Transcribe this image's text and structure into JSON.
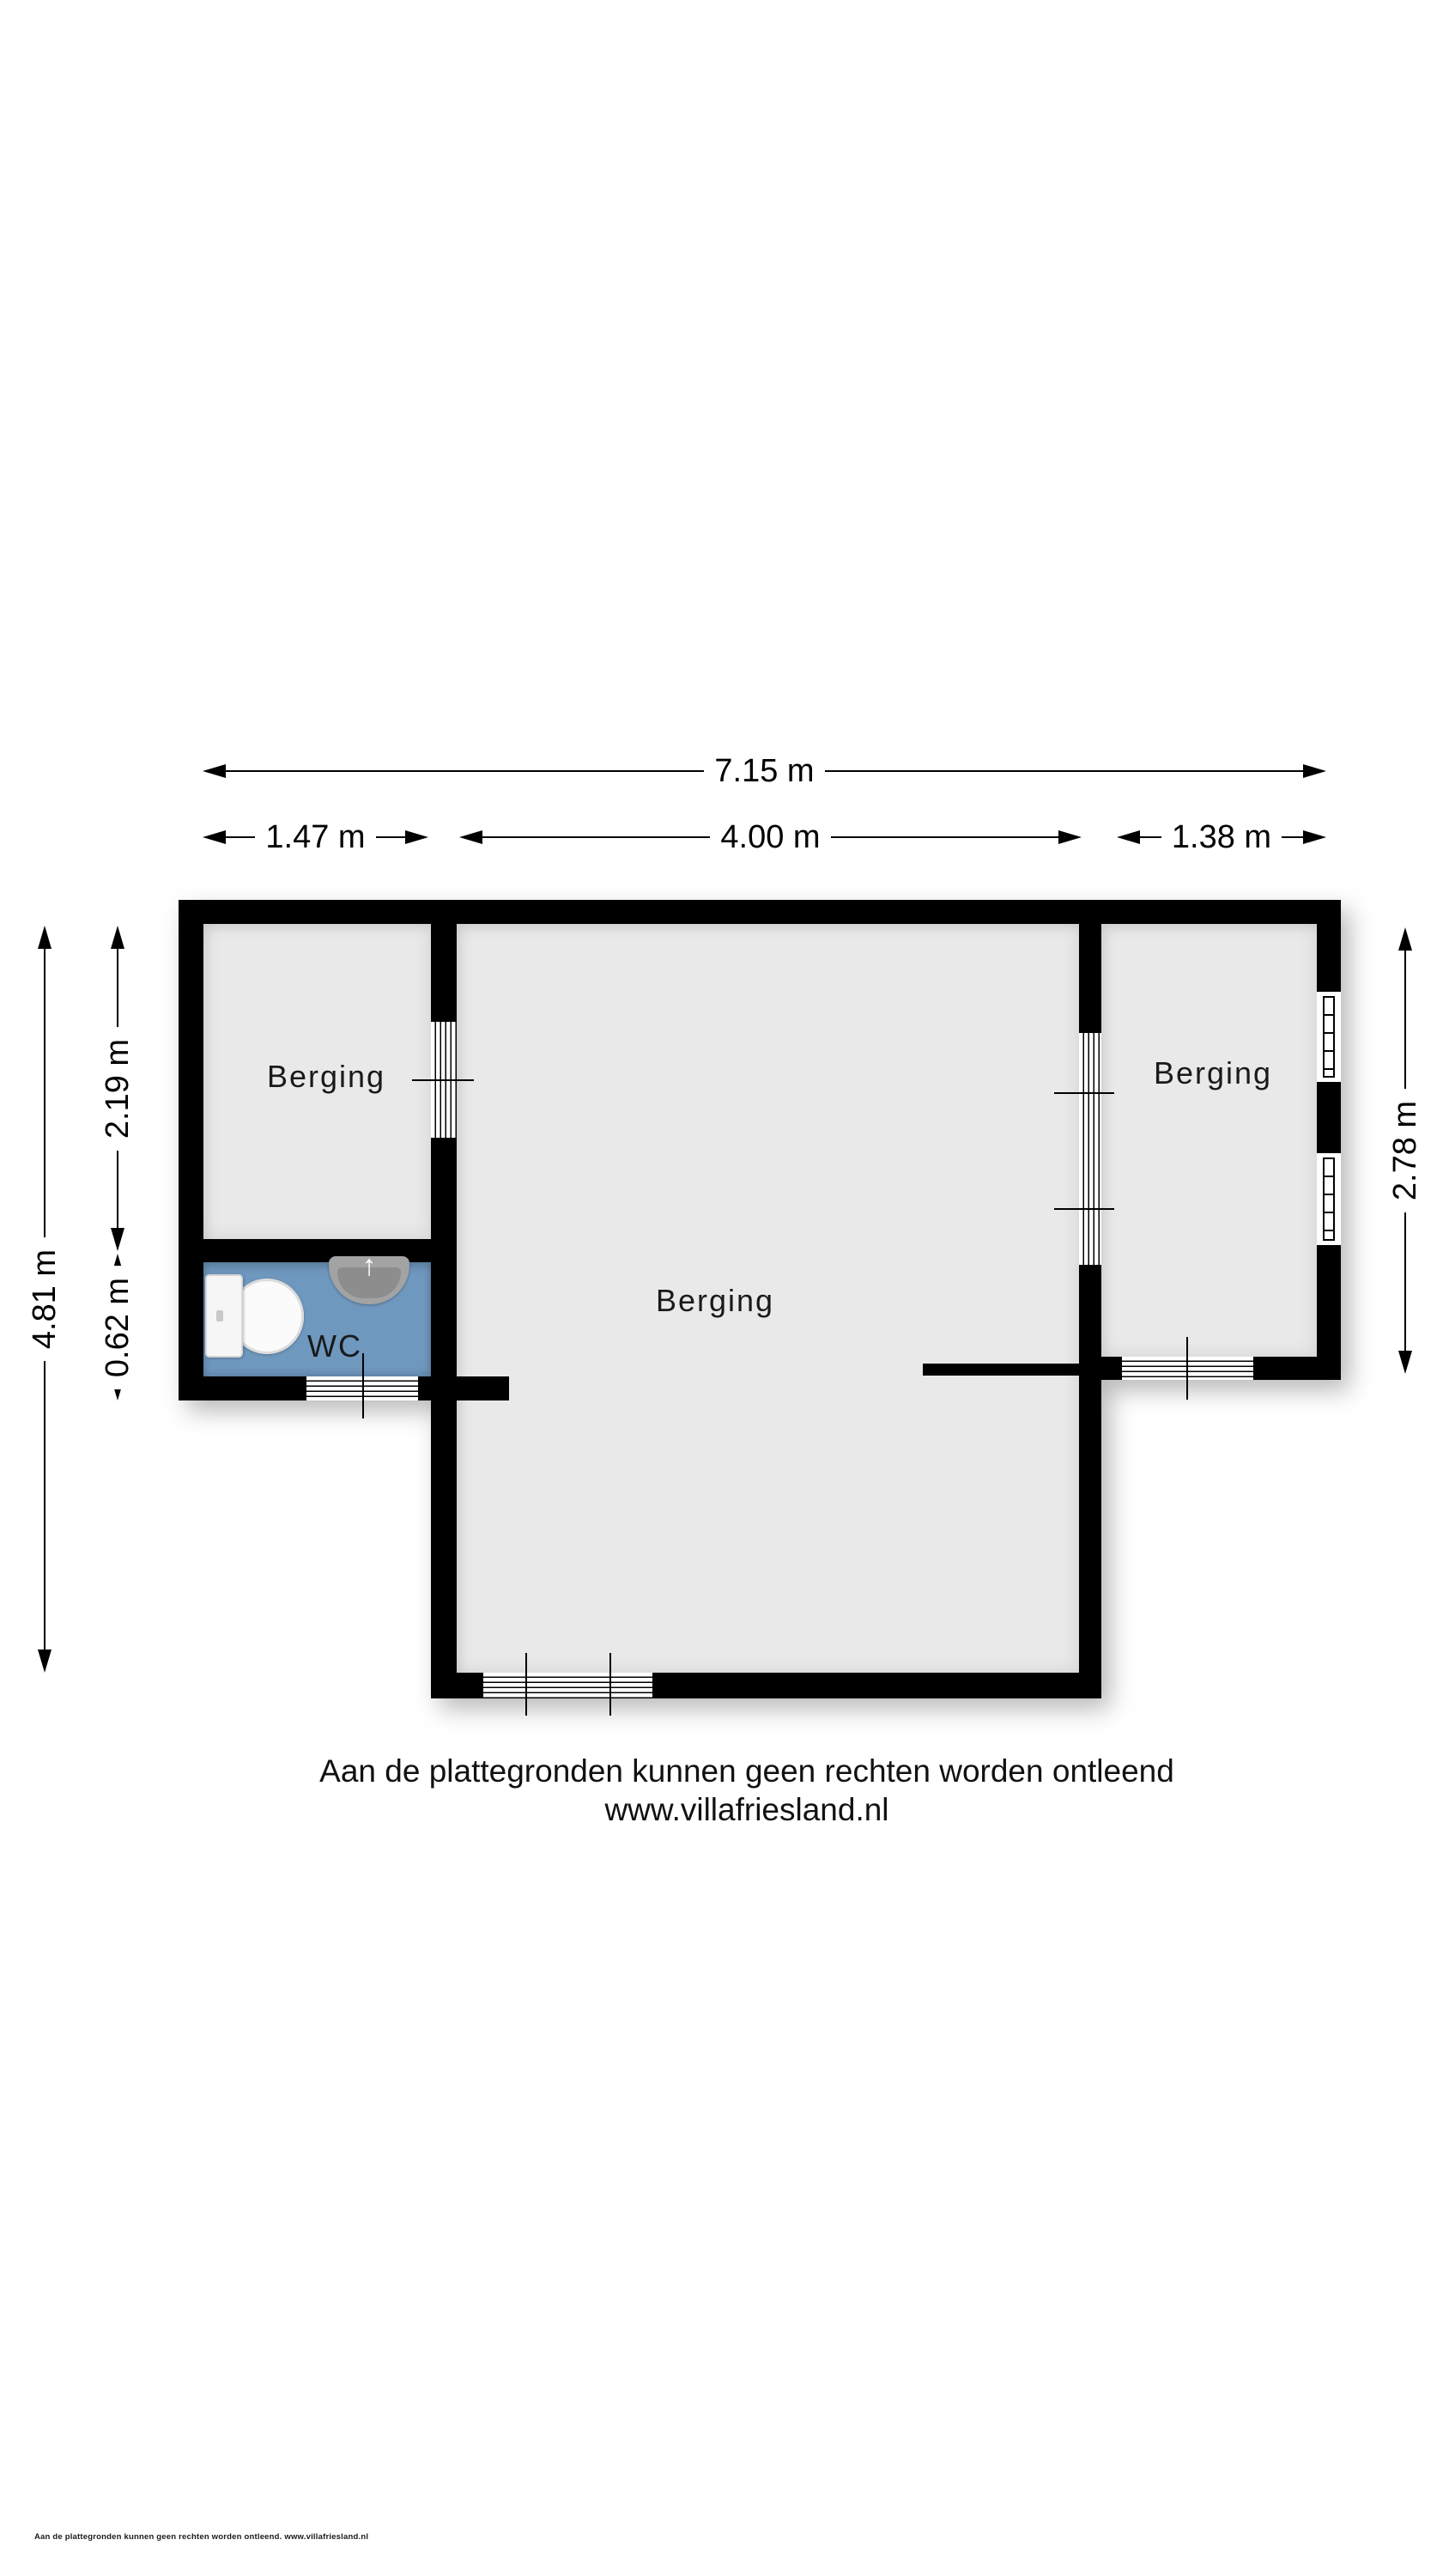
{
  "floorplan": {
    "rooms": [
      {
        "id": "berging-left",
        "label": "Berging"
      },
      {
        "id": "berging-center",
        "label": "Berging"
      },
      {
        "id": "berging-right",
        "label": "Berging"
      },
      {
        "id": "wc",
        "label": "WC"
      }
    ],
    "dimensions": {
      "top_total": "7.15 m",
      "top_left": "1.47 m",
      "top_center": "4.00 m",
      "top_right": "1.38 m",
      "left_total": "4.81 m",
      "left_upper": "2.19 m",
      "left_lower": "0.62 m",
      "right_side": "2.78 m"
    },
    "icons": {
      "sink_tap_arrow": "↑"
    },
    "colors": {
      "wall": "#000000",
      "floor": "#e9e9e9",
      "wc_floor": "#6f98bf",
      "background": "#ffffff"
    }
  },
  "footer": {
    "disclaimer": "Aan de plattegronden kunnen geen rechten worden ontleend",
    "website": "www.villafriesland.nl"
  },
  "fine_print": "Aan de plattegronden kunnen geen rechten worden ontleend. www.villafriesland.nl"
}
